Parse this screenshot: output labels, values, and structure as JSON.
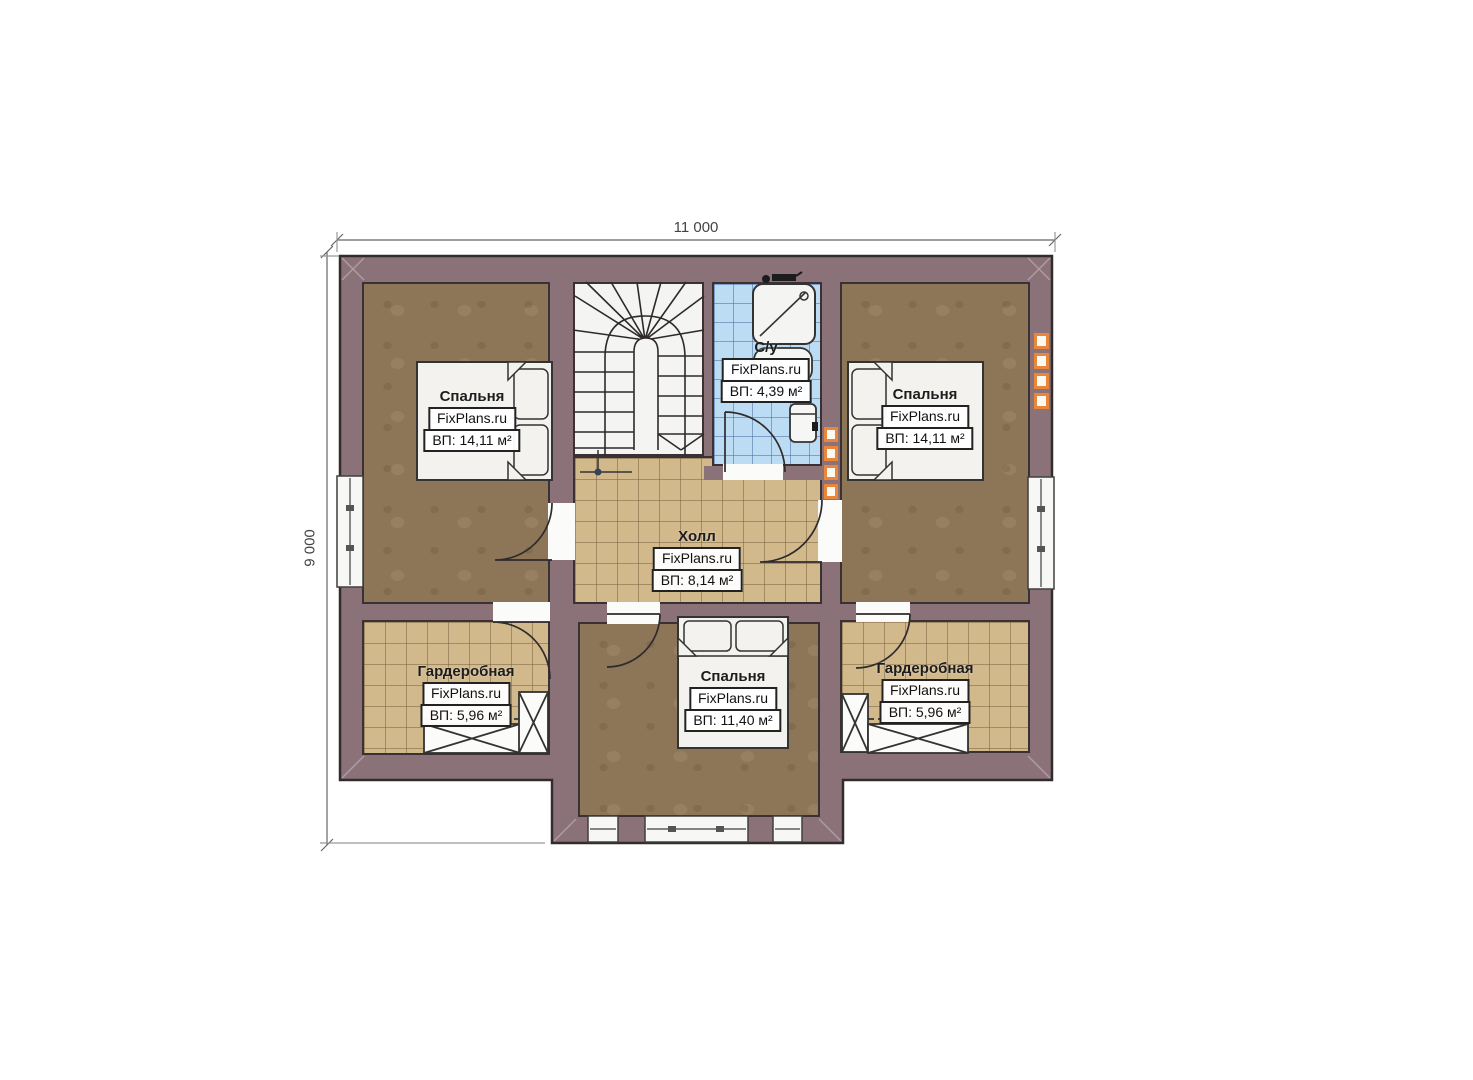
{
  "plan": {
    "type": "floor-plan",
    "brand": "FixPlans.ru"
  },
  "dims": {
    "width_label": "11 000",
    "height_label": "9 000"
  },
  "rooms": [
    {
      "id": "bedroom-left",
      "name": "Спальня",
      "brand": "FixPlans.ru",
      "area": "ВП: 14,11 м²"
    },
    {
      "id": "bathroom",
      "name": "С/у",
      "brand": "FixPlans.ru",
      "area": "ВП: 4,39 м²"
    },
    {
      "id": "bedroom-right",
      "name": "Спальня",
      "brand": "FixPlans.ru",
      "area": "ВП: 14,11 м²"
    },
    {
      "id": "hall",
      "name": "Холл",
      "brand": "FixPlans.ru",
      "area": "ВП: 8,14 м²"
    },
    {
      "id": "wardrobe-left",
      "name": "Гардеробная",
      "brand": "FixPlans.ru",
      "area": "ВП: 5,96 м²"
    },
    {
      "id": "bedroom-bottom",
      "name": "Спальня",
      "brand": "FixPlans.ru",
      "area": "ВП: 11,40 м²"
    },
    {
      "id": "wardrobe-right",
      "name": "Гардеробная",
      "brand": "FixPlans.ru",
      "area": "ВП: 5,96 м²"
    }
  ],
  "icons": [
    "staircase",
    "shower-icon",
    "sink-icon",
    "toilet-icon",
    "double-bed",
    "single-bed",
    "wardrobe-cabinet",
    "door-arc",
    "window",
    "vent-block",
    "dimension-arrow"
  ],
  "colors": {
    "wall": "#8b7278",
    "wall_line": "#3a3135",
    "bedroom_floor": "#8d7557",
    "tile_floor": "#d2b98b",
    "bath_floor": "#bcdcf4",
    "accent_orange": "#e8873c"
  }
}
